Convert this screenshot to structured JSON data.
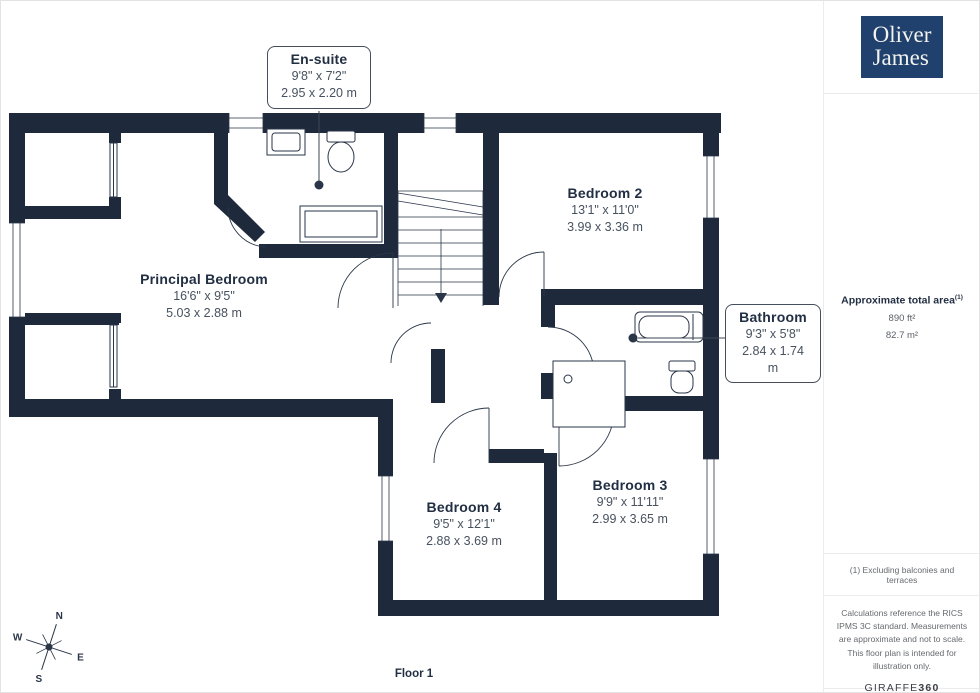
{
  "colors": {
    "wall": "#1e2a3c",
    "accent_text": "#222f43",
    "dimension_text": "#47525f",
    "logo_bg": "#20406e"
  },
  "brand": {
    "name_line1": "Oliver",
    "name_line2": "James"
  },
  "rooms": [
    {
      "name": "En-suite",
      "imperial": "9'8\" x 7'2\"",
      "metric": "2.95 x 2.20 m"
    },
    {
      "name": "Bedroom 2",
      "imperial": "13'1\" x 11'0\"",
      "metric": "3.99 x 3.36 m"
    },
    {
      "name": "Principal Bedroom",
      "imperial": "16'6\" x 9'5\"",
      "metric": "5.03 x 2.88 m"
    },
    {
      "name": "Bathroom",
      "imperial": "9'3\" x 5'8\"",
      "metric": "2.84 x 1.74 m"
    },
    {
      "name": "Bedroom 4",
      "imperial": "9'5\" x 12'1\"",
      "metric": "2.88 x 3.69 m"
    },
    {
      "name": "Bedroom 3",
      "imperial": "9'9\" x 11'11\"",
      "metric": "2.99 x 3.65 m"
    }
  ],
  "area_summary": {
    "title": "Approximate total area",
    "footnote_marker": "(1)",
    "imperial": "890 ft²",
    "metric": "82.7 m²"
  },
  "footnotes": {
    "exclusions": "(1) Excluding balconies and terraces",
    "disclaimer": "Calculations reference the RICS IPMS 3C standard. Measurements are approximate and not to scale. This floor plan is intended for illustration only."
  },
  "provider": {
    "name_regular": "GIRAFFE",
    "name_bold": "360"
  },
  "floor": {
    "label": "Floor 1"
  },
  "compass": {
    "north": "N",
    "east": "E",
    "south": "S",
    "west": "W"
  }
}
